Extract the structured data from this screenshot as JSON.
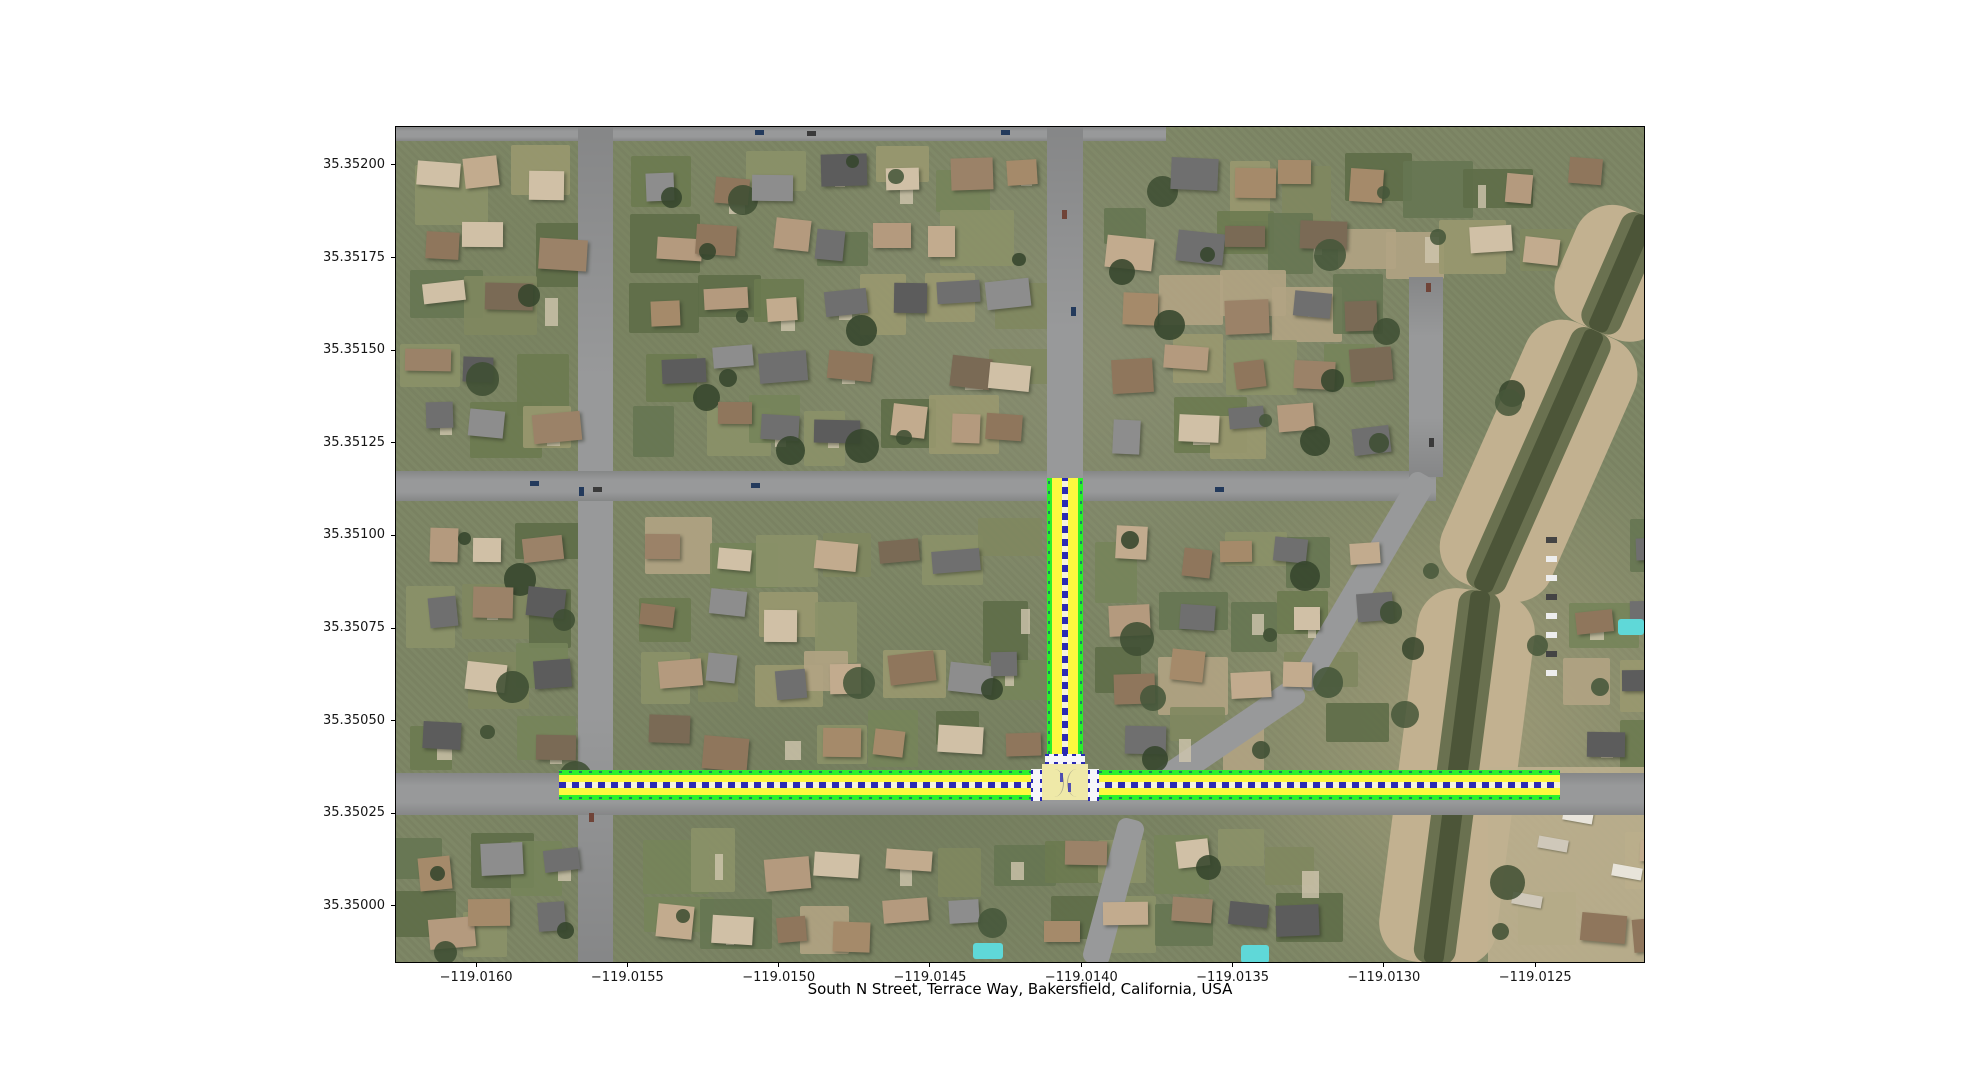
{
  "chart_data": {
    "type": "map",
    "title": "South N Street, Terrace Way, Bakersfield, California, USA",
    "basemap": "aerial satellite imagery of a residential neighborhood with a diagonal drainage canal on the east side",
    "x_axis": {
      "range": [
        -119.016268,
        -119.012137
      ],
      "ticks": [
        {
          "value": -119.016,
          "label": "−119.0160"
        },
        {
          "value": -119.0155,
          "label": "−119.0155"
        },
        {
          "value": -119.015,
          "label": "−119.0150"
        },
        {
          "value": -119.0145,
          "label": "−119.0145"
        },
        {
          "value": -119.014,
          "label": "−119.0140"
        },
        {
          "value": -119.0135,
          "label": "−119.0135"
        },
        {
          "value": -119.013,
          "label": "−119.0130"
        },
        {
          "value": -119.0125,
          "label": "−119.0125"
        }
      ]
    },
    "y_axis": {
      "range": [
        35.349846,
        35.352105
      ],
      "ticks": [
        {
          "value": 35.35,
          "label": "35.35000"
        },
        {
          "value": 35.35025,
          "label": "35.35025"
        },
        {
          "value": 35.3505,
          "label": "35.35050"
        },
        {
          "value": 35.35075,
          "label": "35.35075"
        },
        {
          "value": 35.351,
          "label": "35.35100"
        },
        {
          "value": 35.35125,
          "label": "35.35125"
        },
        {
          "value": 35.3515,
          "label": "35.35150"
        },
        {
          "value": 35.35175,
          "label": "35.35175"
        },
        {
          "value": 35.352,
          "label": "35.35200"
        }
      ]
    },
    "highlighted_streets": [
      {
        "name": "Terrace Way",
        "orientation": "horizontal",
        "lat": 35.35033,
        "lon_start": -119.01573,
        "lon_end": -119.01242
      },
      {
        "name": "South N Street",
        "orientation": "vertical",
        "lon": -119.014057,
        "lat_start": 35.35033,
        "lat_end": 35.351157
      }
    ],
    "junction": {
      "lon": -119.014057,
      "lat": 35.35033,
      "crosswalks": [
        "north",
        "west",
        "east"
      ]
    },
    "colors": {
      "edge_green": "#2bf02b",
      "lane_yellow": "#fbf93f",
      "dash_blue": "#2a2ab4",
      "crosswalk_white": "#f6f6fa",
      "junction_fill": "#efe9a8"
    }
  }
}
